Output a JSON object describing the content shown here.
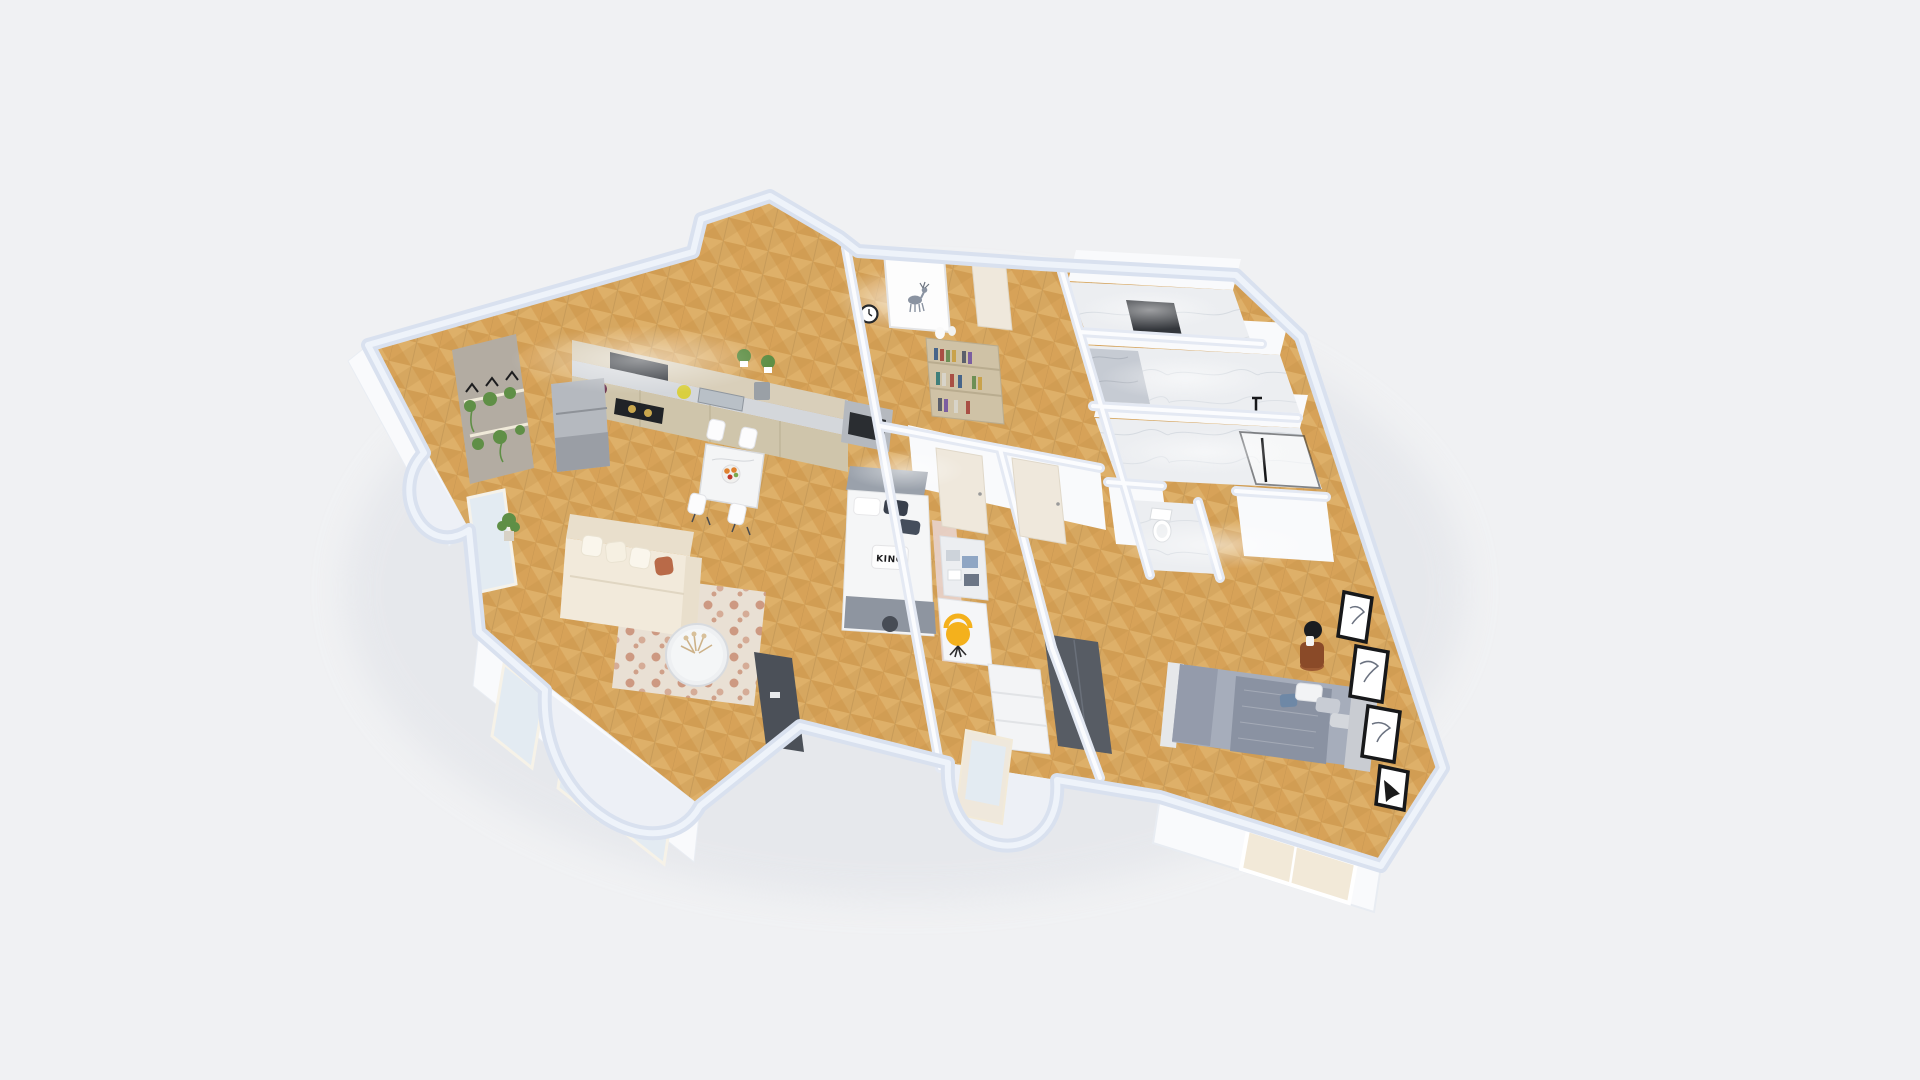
{
  "scene": {
    "type": "3d-dollhouse-floorplan-render",
    "view": "perspective-top",
    "background": "#f0f1f3",
    "pillow_text": "KING",
    "colors": {
      "background": "#f0f1f3",
      "shadow": "#e2e4e9",
      "wallCap": "#d9e1ef",
      "wallCapLight": "#eef3fa",
      "wallInterior": "#e4e9f3",
      "wallFace": "#f9fafc",
      "wood": "#d7a258",
      "woodLight": "#e6bd79",
      "woodDark": "#c18f46",
      "marble": "#eceef1",
      "marbleVein": "#ced3db",
      "stoneDark": "#33363b",
      "accentStoneWall": "#b3aca2",
      "cabinetUpper": "#d9cfba",
      "cabinetBase": "#cfc5ab",
      "counterTop": "#d4d7db",
      "applianceSteel": "#b5b9bf",
      "hoodBlack": "#2c3036",
      "cooktopBlack": "#202327",
      "sofaCream": "#f2eadb",
      "sofaBack": "#e9dfcc",
      "pillowRust": "#b96a48",
      "rugBase": "#e9e0d4",
      "rugRust": "#b65f3d",
      "tableWhite": "#f4f5f6",
      "tvDark": "#4b5058",
      "bookshelfTan": "#cfc2a6",
      "bedWhite": "#f5f6f7",
      "bedHeadboard": "#9aa1ab",
      "throwGray": "#8e95a0",
      "pillowDark": "#39404c",
      "blushRug": "#e8d3cd",
      "deskWhite": "#f5f6f8",
      "accentYellow": "#f4b11c",
      "doorCream": "#efe8dc",
      "masterDuvet": "#a6adbb",
      "masterBlanket": "#8a92a2",
      "pillowBlue": "#6e88a6",
      "wardrobeDark": "#575c64",
      "nightstandWood": "#8a4a28",
      "lampBlack": "#1b1d20",
      "frameBlack": "#17181a",
      "glass": "#e3ebf2",
      "windowWarm": "#f2e9d8",
      "plantGreen": "#5f8f46",
      "toiletWhite": "#ffffff",
      "porchFill": "#edf0f6",
      "fruitOrange": "#e0812f",
      "fruitRed": "#c0392b",
      "lemonYellow": "#d9cf3f"
    },
    "rooms": [
      {
        "id": "kitchen"
      },
      {
        "id": "dining-area"
      },
      {
        "id": "living-room"
      },
      {
        "id": "entry-hall"
      },
      {
        "id": "kids-bedroom"
      },
      {
        "id": "hallway"
      },
      {
        "id": "bathroom-top"
      },
      {
        "id": "bathroom-middle"
      },
      {
        "id": "shower-room"
      },
      {
        "id": "wc"
      },
      {
        "id": "master-bedroom"
      },
      {
        "id": "balcony-left"
      },
      {
        "id": "porch-center"
      }
    ]
  }
}
